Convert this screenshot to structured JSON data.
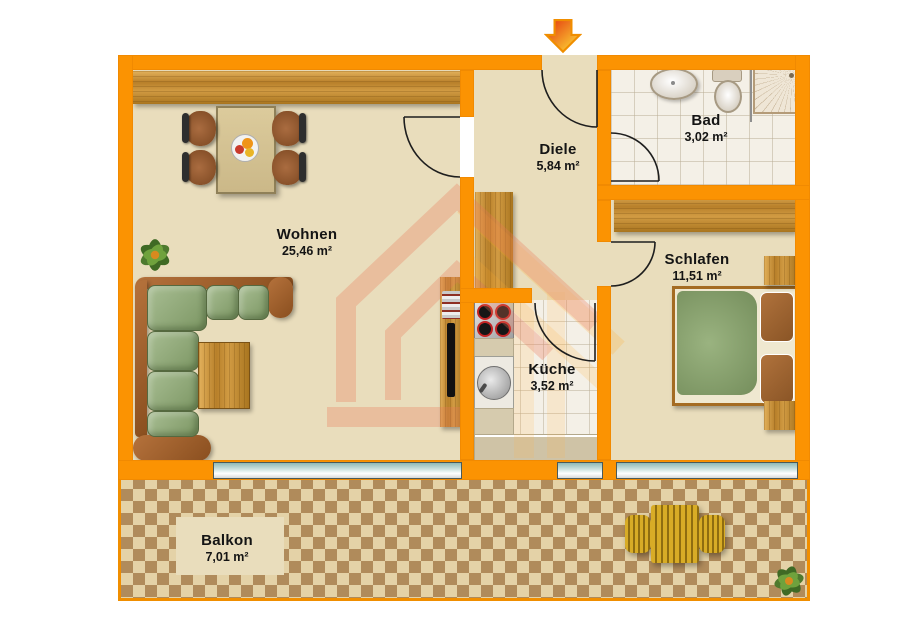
{
  "plan": {
    "type": "floorplan",
    "rooms": {
      "wohnen": {
        "name": "Wohnen",
        "area": "25,46 m²"
      },
      "diele": {
        "name": "Diele",
        "area": "5,84 m²"
      },
      "bad": {
        "name": "Bad",
        "area": "3,02 m²"
      },
      "schlafen": {
        "name": "Schlafen",
        "area": "11,51 m²"
      },
      "kueche": {
        "name": "Küche",
        "area": "3,52 m²"
      },
      "balkon": {
        "name": "Balkon",
        "area": "7,01 m²"
      }
    },
    "colors": {
      "wall": "#FB9302",
      "floor": "#E9DDBC",
      "tile": "#F4F0E7",
      "checker_light": "#E4D2A7",
      "checker_dark": "#B08B5B",
      "window_glass": "#C3DCD9",
      "watermark": "#EF8760",
      "entrance_arrow_start": "#E3330D",
      "entrance_arrow_end": "#FFE53A"
    }
  }
}
